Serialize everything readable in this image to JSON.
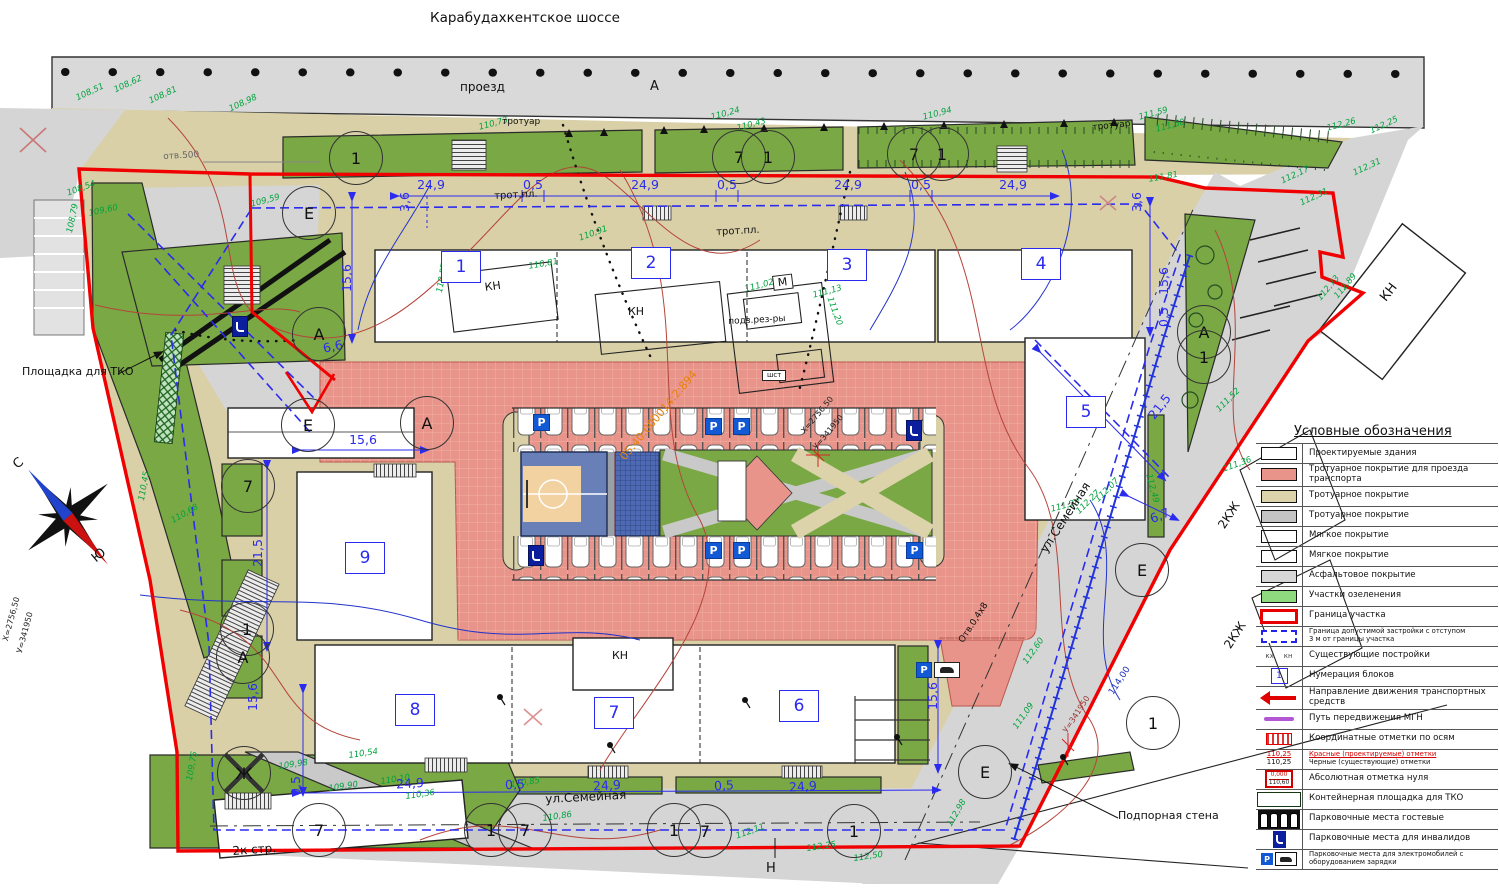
{
  "colors": {
    "boundary": "#f00000",
    "setback": "#2b2bf0",
    "dimension": "#2b2bf0",
    "elevation_text": "#00a33e",
    "courtyard": "#e8948a",
    "greenery": "#7aa845",
    "asphalt": "#d5d5d5",
    "sidewalk": "#d9d0a8",
    "cadastral_text": "#e8820c",
    "mgn": "#b356d6"
  },
  "header": {
    "highway": "Карабудахкентское шоссе",
    "driveway": "проезд",
    "driveway_letter": "А"
  },
  "compass": {
    "north": "С",
    "south": "Ю"
  },
  "parking": {
    "sign": "P",
    "items": [
      {
        "x": 533,
        "y": 414,
        "t": "p"
      },
      {
        "x": 705,
        "y": 418,
        "t": "p"
      },
      {
        "x": 733,
        "y": 418,
        "t": "p"
      },
      {
        "x": 705,
        "y": 542,
        "t": "p"
      },
      {
        "x": 733,
        "y": 542,
        "t": "p"
      },
      {
        "x": 906,
        "y": 542,
        "t": "p"
      },
      {
        "x": 906,
        "y": 420,
        "t": "d"
      },
      {
        "x": 528,
        "y": 545,
        "t": "d"
      },
      {
        "x": 232,
        "y": 316,
        "t": "d"
      },
      {
        "x": 916,
        "y": 662,
        "t": "ev"
      }
    ]
  },
  "blocks": [
    {
      "n": "1",
      "x": 460,
      "y": 266
    },
    {
      "n": "2",
      "x": 650,
      "y": 262
    },
    {
      "n": "3",
      "x": 846,
      "y": 264
    },
    {
      "n": "4",
      "x": 1040,
      "y": 263
    },
    {
      "n": "5",
      "x": 1085,
      "y": 411
    },
    {
      "n": "6",
      "x": 798,
      "y": 705
    },
    {
      "n": "7",
      "x": 613,
      "y": 712
    },
    {
      "n": "8",
      "x": 414,
      "y": 709
    },
    {
      "n": "9",
      "x": 364,
      "y": 557
    }
  ],
  "axis_circles": [
    {
      "t": "1",
      "x": 355,
      "y": 157
    },
    {
      "t": "7",
      "x": 738,
      "y": 156
    },
    {
      "t": "1",
      "x": 767,
      "y": 156
    },
    {
      "t": "7",
      "x": 913,
      "y": 153
    },
    {
      "t": "1",
      "x": 941,
      "y": 153
    },
    {
      "t": "Е",
      "x": 308,
      "y": 212
    },
    {
      "t": "А",
      "x": 318,
      "y": 333
    },
    {
      "t": "Е",
      "x": 307,
      "y": 424
    },
    {
      "t": "А",
      "x": 426,
      "y": 422
    },
    {
      "t": "7",
      "x": 247,
      "y": 485
    },
    {
      "t": "1",
      "x": 246,
      "y": 628
    },
    {
      "t": "А",
      "x": 242,
      "y": 656
    },
    {
      "t": "А",
      "x": 1203,
      "y": 331
    },
    {
      "t": "1",
      "x": 1203,
      "y": 356
    },
    {
      "t": "Е",
      "x": 1141,
      "y": 569
    },
    {
      "t": "1",
      "x": 1152,
      "y": 722
    },
    {
      "t": "Е",
      "x": 984,
      "y": 771
    },
    {
      "t": "Ж",
      "x": 243,
      "y": 772,
      "xd": 1
    },
    {
      "t": "7",
      "x": 318,
      "y": 829
    },
    {
      "t": "1",
      "x": 490,
      "y": 829
    },
    {
      "t": "7",
      "x": 524,
      "y": 829
    },
    {
      "t": "1",
      "x": 673,
      "y": 829
    },
    {
      "t": "7",
      "x": 704,
      "y": 830
    },
    {
      "t": "1",
      "x": 853,
      "y": 830
    }
  ],
  "dimensions": [
    {
      "v": "24,9",
      "x": 431,
      "y": 185,
      "r": 0
    },
    {
      "v": "0,5",
      "x": 533,
      "y": 185,
      "r": 0
    },
    {
      "v": "24,9",
      "x": 645,
      "y": 185,
      "r": 0
    },
    {
      "v": "0,5",
      "x": 727,
      "y": 185,
      "r": 0
    },
    {
      "v": "24,9",
      "x": 848,
      "y": 185,
      "r": 0
    },
    {
      "v": "0,5",
      "x": 921,
      "y": 185,
      "r": 0
    },
    {
      "v": "24,9",
      "x": 1013,
      "y": 185,
      "r": 0
    },
    {
      "v": "3,6",
      "x": 405,
      "y": 202,
      "r": -90
    },
    {
      "v": "3,6",
      "x": 1137,
      "y": 202,
      "r": -90
    },
    {
      "v": "15,6",
      "x": 347,
      "y": 278,
      "r": -90
    },
    {
      "v": "6,6",
      "x": 333,
      "y": 347,
      "r": -12
    },
    {
      "v": "15,6",
      "x": 363,
      "y": 440,
      "r": 0
    },
    {
      "v": "21,5",
      "x": 258,
      "y": 553,
      "r": -90
    },
    {
      "v": "15,6",
      "x": 1164,
      "y": 281,
      "r": -90
    },
    {
      "v": "0,5",
      "x": 1164,
      "y": 317,
      "r": -90
    },
    {
      "v": "21,5",
      "x": 1160,
      "y": 407,
      "r": -52
    },
    {
      "v": "6,7",
      "x": 1160,
      "y": 516,
      "r": -22
    },
    {
      "v": "15,6",
      "x": 933,
      "y": 696,
      "r": -90
    },
    {
      "v": "15,6",
      "x": 253,
      "y": 697,
      "r": -90
    },
    {
      "v": "0,5",
      "x": 296,
      "y": 786,
      "r": -90
    },
    {
      "v": "24,9",
      "x": 410,
      "y": 784,
      "r": -3
    },
    {
      "v": "0,5",
      "x": 515,
      "y": 785,
      "r": -3
    },
    {
      "v": "24,9",
      "x": 607,
      "y": 786,
      "r": -3
    },
    {
      "v": "0,5",
      "x": 724,
      "y": 786,
      "r": -3
    },
    {
      "v": "24,9",
      "x": 803,
      "y": 787,
      "r": -3
    }
  ],
  "elevations": [
    {
      "v": "108,51",
      "x": 75,
      "y": 95,
      "r": -25
    },
    {
      "v": "108,62",
      "x": 113,
      "y": 87,
      "r": -25
    },
    {
      "v": "108,81",
      "x": 148,
      "y": 98,
      "r": -25
    },
    {
      "v": "108,98",
      "x": 228,
      "y": 106,
      "r": -25
    },
    {
      "v": "108,54",
      "x": 66,
      "y": 190,
      "r": -20
    },
    {
      "v": "109,60",
      "x": 88,
      "y": 210,
      "r": -12
    },
    {
      "v": "108,79",
      "x": 66,
      "y": 232,
      "r": -78
    },
    {
      "v": "109,59",
      "x": 250,
      "y": 201,
      "r": -15
    },
    {
      "v": "110,73",
      "x": 478,
      "y": 124,
      "r": -15
    },
    {
      "v": "110,24",
      "x": 710,
      "y": 114,
      "r": -15
    },
    {
      "v": "110,43",
      "x": 736,
      "y": 125,
      "r": -15
    },
    {
      "v": "110,94",
      "x": 922,
      "y": 114,
      "r": -15
    },
    {
      "v": "111,59",
      "x": 1138,
      "y": 114,
      "r": -15
    },
    {
      "v": "111,60",
      "x": 1155,
      "y": 126,
      "r": -15
    },
    {
      "v": "112,26",
      "x": 1326,
      "y": 125,
      "r": -15
    },
    {
      "v": "112,25",
      "x": 1369,
      "y": 128,
      "r": -25
    },
    {
      "v": "112,31",
      "x": 1352,
      "y": 170,
      "r": -25
    },
    {
      "v": "112,17",
      "x": 1280,
      "y": 178,
      "r": -25
    },
    {
      "v": "112,31",
      "x": 1299,
      "y": 200,
      "r": -25
    },
    {
      "v": "112,73",
      "x": 1316,
      "y": 297,
      "r": -50
    },
    {
      "v": "112,89",
      "x": 1333,
      "y": 295,
      "r": -50
    },
    {
      "v": "111,81",
      "x": 1148,
      "y": 176,
      "r": -10
    },
    {
      "v": "110,91",
      "x": 578,
      "y": 235,
      "r": -20
    },
    {
      "v": "110,81",
      "x": 528,
      "y": 263,
      "r": -10
    },
    {
      "v": "110,57",
      "x": 436,
      "y": 292,
      "r": -80
    },
    {
      "v": "111,02",
      "x": 744,
      "y": 286,
      "r": -15
    },
    {
      "v": "111,13",
      "x": 812,
      "y": 292,
      "r": -15
    },
    {
      "v": "111,20",
      "x": 833,
      "y": 296,
      "r": 70
    },
    {
      "v": "110,45",
      "x": 138,
      "y": 500,
      "r": -80
    },
    {
      "v": "110,68",
      "x": 170,
      "y": 518,
      "r": -30
    },
    {
      "v": "109,75",
      "x": 186,
      "y": 780,
      "r": -80
    },
    {
      "v": "109,90",
      "x": 328,
      "y": 785,
      "r": -8
    },
    {
      "v": "109,98",
      "x": 278,
      "y": 763,
      "r": -8
    },
    {
      "v": "110,54",
      "x": 348,
      "y": 752,
      "r": -8
    },
    {
      "v": "110,10",
      "x": 380,
      "y": 778,
      "r": -8
    },
    {
      "v": "110,36",
      "x": 405,
      "y": 793,
      "r": -8
    },
    {
      "v": "110,85",
      "x": 510,
      "y": 781,
      "r": -8
    },
    {
      "v": "110,86",
      "x": 542,
      "y": 815,
      "r": -8
    },
    {
      "v": "112,11",
      "x": 735,
      "y": 833,
      "r": -20
    },
    {
      "v": "112,25",
      "x": 806,
      "y": 845,
      "r": -8
    },
    {
      "v": "112,50",
      "x": 853,
      "y": 855,
      "r": -8
    },
    {
      "v": "112,98",
      "x": 946,
      "y": 824,
      "r": -60
    },
    {
      "v": "112,60",
      "x": 1022,
      "y": 661,
      "r": -55
    },
    {
      "v": "111,09",
      "x": 1012,
      "y": 726,
      "r": -55
    },
    {
      "v": "111,36",
      "x": 1222,
      "y": 466,
      "r": -20
    },
    {
      "v": "111,52",
      "x": 1215,
      "y": 408,
      "r": -45
    },
    {
      "v": "112,49",
      "x": 1152,
      "y": 473,
      "r": 75
    },
    {
      "v": "111,28",
      "x": 1050,
      "y": 506,
      "r": -15
    },
    {
      "v": "112,27",
      "x": 1075,
      "y": 510,
      "r": -45
    },
    {
      "v": "112,07",
      "x": 1094,
      "y": 498,
      "r": -45
    }
  ],
  "annotations": [
    {
      "t": "Площадка для ТКО",
      "x": 22,
      "y": 366,
      "r": 0,
      "f": 11,
      "c": "#111"
    },
    {
      "t": "Подпорная стена",
      "x": 1118,
      "y": 810,
      "r": 0,
      "f": 11,
      "c": "#111"
    },
    {
      "t": "ул.Семейная",
      "x": 1038,
      "y": 548,
      "r": -57,
      "f": 12,
      "c": "#111"
    },
    {
      "t": "ул.Семейная",
      "x": 545,
      "y": 793,
      "r": -3,
      "f": 12,
      "c": "#111"
    },
    {
      "t": "2к стр.",
      "x": 232,
      "y": 845,
      "r": -4,
      "f": 12,
      "c": "#111"
    },
    {
      "t": "КН",
      "x": 484,
      "y": 282,
      "r": -8,
      "f": 11,
      "c": "#111"
    },
    {
      "t": "КН",
      "x": 628,
      "y": 306,
      "r": 0,
      "f": 11,
      "c": "#111"
    },
    {
      "t": "КН",
      "x": 612,
      "y": 650,
      "r": 0,
      "f": 11,
      "c": "#111"
    },
    {
      "t": "КН",
      "x": 1378,
      "y": 296,
      "r": -52,
      "f": 13,
      "c": "#111"
    },
    {
      "t": "2КЖ",
      "x": 1216,
      "y": 524,
      "r": -57,
      "f": 12,
      "c": "#111"
    },
    {
      "t": "2КЖ",
      "x": 1222,
      "y": 644,
      "r": -57,
      "f": 12,
      "c": "#111"
    },
    {
      "t": "М",
      "x": 772,
      "y": 276,
      "r": -7,
      "f": 11,
      "c": "#111",
      "box": 1
    },
    {
      "t": "подз.рез-ры",
      "x": 728,
      "y": 318,
      "r": -3,
      "f": 9,
      "c": "#111"
    },
    {
      "t": "шст",
      "x": 762,
      "y": 370,
      "r": 0,
      "f": 7,
      "c": "#111",
      "box": 1
    },
    {
      "t": "трот.пл.",
      "x": 494,
      "y": 192,
      "r": -3,
      "f": 10,
      "c": "#111"
    },
    {
      "t": "трот.пл.",
      "x": 716,
      "y": 228,
      "r": -3,
      "f": 10,
      "c": "#111"
    },
    {
      "t": "тротуар",
      "x": 502,
      "y": 118,
      "r": 0,
      "f": 9,
      "c": "#111"
    },
    {
      "t": "тротуар",
      "x": 1092,
      "y": 124,
      "r": -6,
      "f": 9,
      "c": "#111"
    },
    {
      "t": "отв.500",
      "x": 163,
      "y": 153,
      "r": -3,
      "f": 9,
      "c": "#666"
    },
    {
      "t": "Отв.0,4х8",
      "x": 958,
      "y": 640,
      "r": -57,
      "f": 9,
      "c": "#111"
    },
    {
      "t": "Н",
      "x": 766,
      "y": 862,
      "r": 0,
      "f": 13,
      "c": "#111"
    },
    {
      "t": "05:40:000014:2:894",
      "x": 618,
      "y": 455,
      "r": -50,
      "f": 11,
      "c": "#e8820c"
    },
    {
      "t": "Х=2756,50",
      "x": 800,
      "y": 430,
      "r": -50,
      "f": 8,
      "c": "#222"
    },
    {
      "t": "У=341950",
      "x": 812,
      "y": 446,
      "r": -50,
      "f": 8,
      "c": "#222"
    },
    {
      "t": "У=341950",
      "x": 1062,
      "y": 730,
      "r": -57,
      "f": 8,
      "c": "#993333"
    },
    {
      "t": "Х=2756,50",
      "x": 2,
      "y": 640,
      "r": -75,
      "f": 8,
      "c": "#222"
    },
    {
      "t": "У=341950",
      "x": 16,
      "y": 652,
      "r": -75,
      "f": 8,
      "c": "#222"
    },
    {
      "t": "114,00",
      "x": 1108,
      "y": 692,
      "r": -57,
      "f": 9,
      "c": "#2233bb"
    }
  ],
  "legend": {
    "title": "Условные обозначения",
    "items": [
      {
        "sw": "white",
        "label": "Проектируемые здания"
      },
      {
        "sw": "salmon",
        "label": "Тротуарное покрытие для проезда транспорта"
      },
      {
        "sw": "tan",
        "label": "Тротуарное покрытие"
      },
      {
        "sw": "gray",
        "label": "Тротуарное покрытие"
      },
      {
        "sw": "softred",
        "label": "Мягкое покрытие"
      },
      {
        "sw": "softblue",
        "label": "Мягкое покрытие"
      },
      {
        "sw": "asph",
        "label": "Асфальтовое покрытие"
      },
      {
        "sw": "green",
        "label": "Участки озеленения"
      },
      {
        "sw": "redborder",
        "label": "Граница участка"
      },
      {
        "sw": "bluedash",
        "label": "Граница допустимой застройки с отступом",
        "label2": "3 м от границы участка",
        "small": 1
      },
      {
        "sw": "kx",
        "v1": "кх",
        "v2": "кн",
        "label": "Существующие постройки"
      },
      {
        "sw": "numbox",
        "v1": "1",
        "label": "Нумерация блоков"
      },
      {
        "sw": "arrow",
        "label": "Направление движения транспортных средств"
      },
      {
        "sw": "mgn",
        "label": "Путь передвижения МГН"
      },
      {
        "sw": "coord",
        "label": "Координатные отметки по осям"
      },
      {
        "sw": "marks",
        "v1": "110,25",
        "v2": "110,25",
        "label": "Красные (проектируемые) отметки",
        "label2": "Черные (существующие) отметки",
        "small": 1,
        "redfirst": 1
      },
      {
        "sw": "abszero",
        "v1": "0,000",
        "v2": "110,60",
        "label": "Абсолютная отметка нуля"
      },
      {
        "sw": "tko",
        "label": "Контейнерная площадка для ТКО"
      },
      {
        "sw": "guest",
        "label": "Парковочные места гостевые"
      },
      {
        "sw": "disabled",
        "label": "Парковочные места для инвалидов"
      },
      {
        "sw": "ev",
        "label": "Парковочные места для электромобилей с оборудованием зарядки",
        "small": 1
      }
    ]
  }
}
